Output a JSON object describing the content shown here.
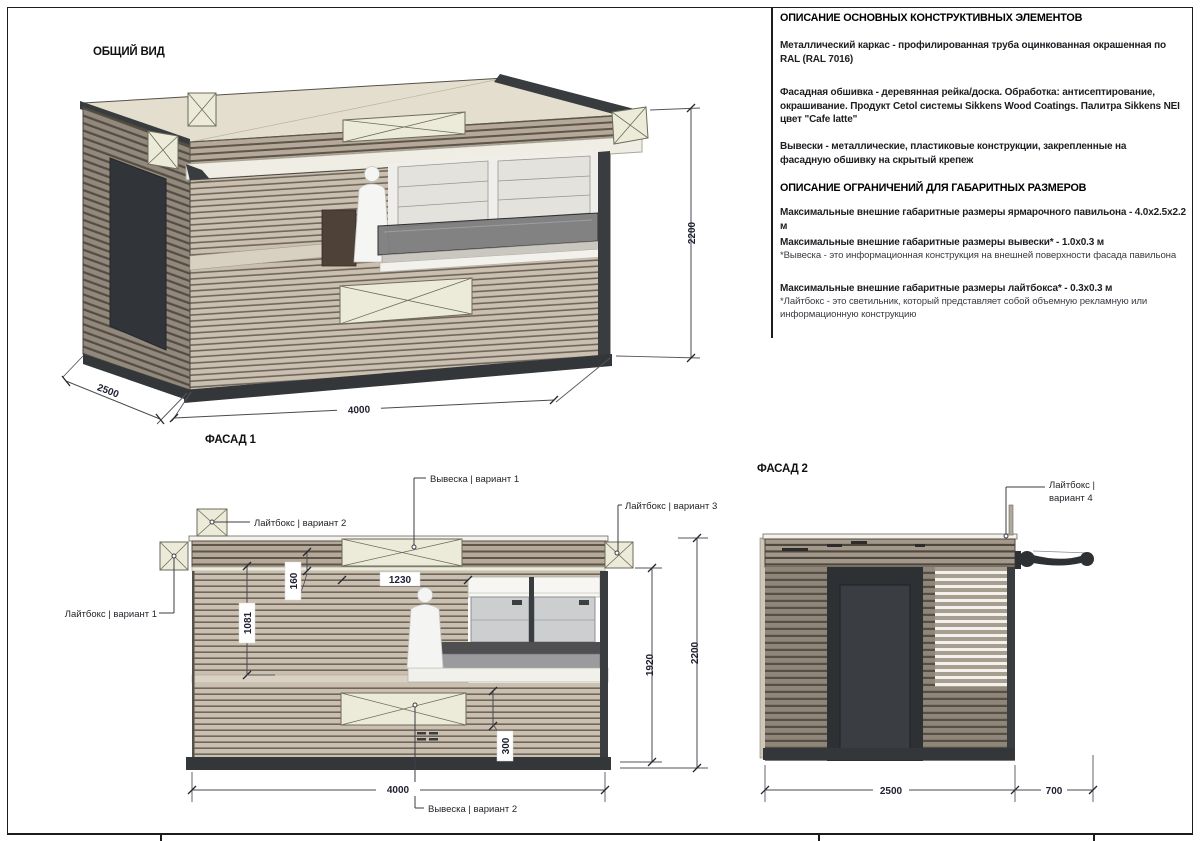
{
  "titles": {
    "general_view": "ОБЩИЙ ВИД",
    "facade1": "ФАСАД 1",
    "facade2": "ФАСАД 2"
  },
  "specs": {
    "heading1": "ОПИСАНИЕ ОСНОВНЫХ КОНСТРУКТИВНЫХ ЭЛЕМЕНТОВ",
    "para1": "Металлический каркас - профилированная труба оцинкованная окрашенная по RAL (RAL 7016)",
    "para2": "Фасадная обшивка - деревянная рейка/доска. Обработка: антисептирование, окрашивание. Продукт Cetol системы Sikkens Wood Coatings. Палитра Sikkens NEI цвет \"Cafe latte\"",
    "para3": "Вывески - металлические, пластиковые конструкции, закрепленные на фасадную обшивку на скрытый крепеж",
    "heading2": "ОПИСАНИЕ ОГРАНИЧЕНИЙ ДЛЯ ГАБАРИТНЫХ РАЗМЕРОВ",
    "para4": "Максимальные внешние габаритные размеры ярмарочного павильона - 4.0х2.5х2.2 м",
    "para5_bold": "Максимальные внешние габаритные размеры вывески* - 1.0х0.3 м",
    "para5_note": "*Вывеска - это информационная конструкция на внешней поверхности фасада павильона",
    "para6_bold": "Максимальные внешние габаритные размеры лайтбокса* - 0.3х0.3 м",
    "para6_note": "*Лайтбокс  - это светильник, который представляет собой объемную рекламную или информационную конструкцию"
  },
  "callouts": {
    "lightbox_v1": "Лайтбокс | вариант 1",
    "lightbox_v2": "Лайтбокс | вариант 2",
    "lightbox_v3": "Лайтбокс | вариант 3",
    "lightbox_v4_line1": "Лайтбокс |",
    "lightbox_v4_line2": "вариант 4",
    "sign_v1": "Вывеска | вариант 1",
    "sign_v2": "Вывеска | вариант 2"
  },
  "dims": {
    "overall_height": "2200",
    "overall_depth": "2500",
    "overall_width": "4000",
    "facade1_width": "4000",
    "facade1_sign_width": "1230",
    "facade1_fascia": "160",
    "facade1_wall": "1081",
    "facade1_sign2_height": "300",
    "facade1_inner_height": "1920",
    "facade1_height": "2200",
    "facade2_width": "2500",
    "facade2_awning": "700"
  },
  "colors": {
    "wood_light_board": "#cbbfb0",
    "wood_light_gap": "#6f675b",
    "wood_fascia_board": "#b6a999",
    "wood_fascia_gap": "#5e564b",
    "wood_dark_board": "#8f8679",
    "wood_dark_gap": "#564f46",
    "panel_cream": "#ecead9",
    "roof_cream": "#e3decd",
    "frame_dark": "#33373a",
    "dim_text": "#1e2030"
  }
}
